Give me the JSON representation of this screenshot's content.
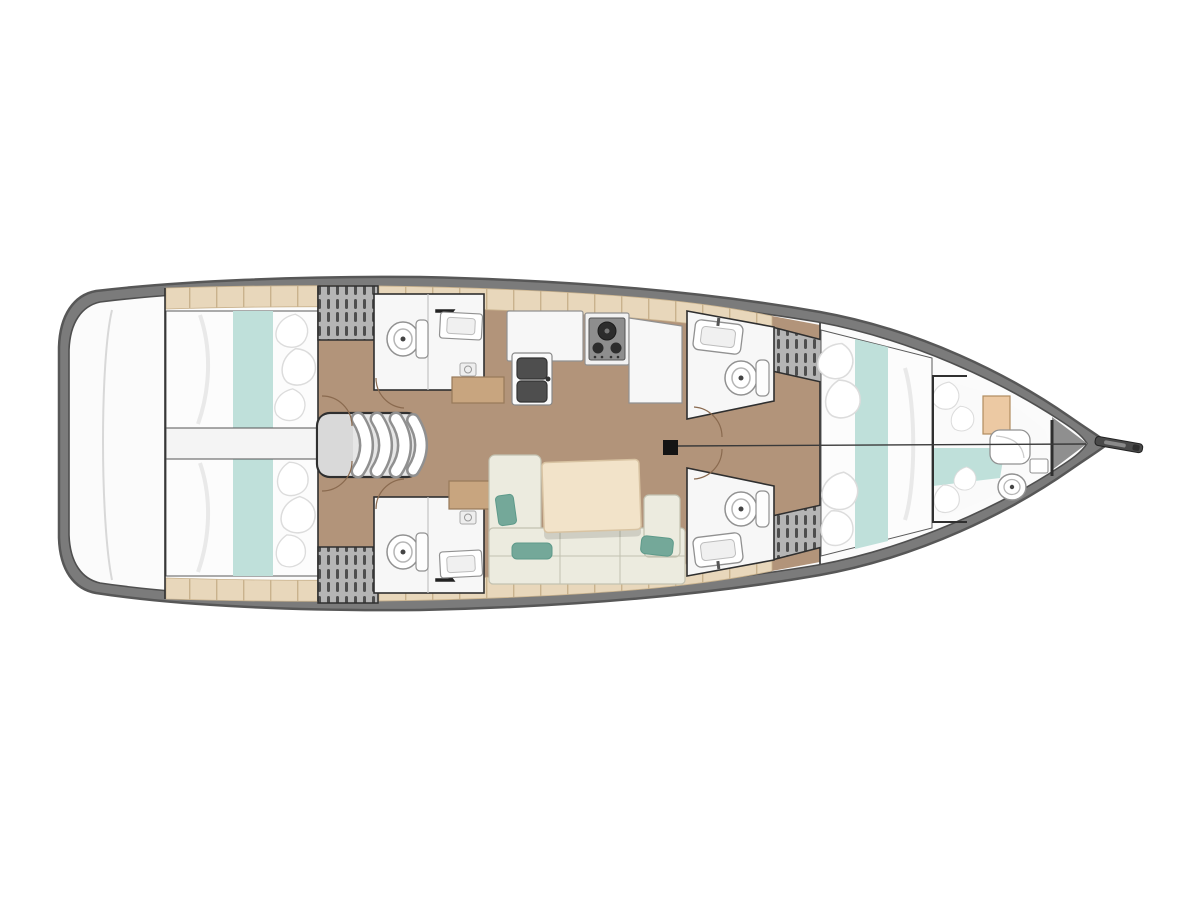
{
  "meta": {
    "view": "sailing-yacht-interior-floor-plan",
    "orientation": "bow-right"
  },
  "palette": {
    "bg": "#ffffff",
    "hullBand": "#7b7b7b",
    "hullEdge": "#575757",
    "deck": "#fbfbfb",
    "deckLine": "#4f4f4f",
    "bowWedge": "#8f8f8f",
    "floorTan": "#b2947a",
    "deckStrip": "#e8d7bb",
    "deckStripLine": "#c9b28d",
    "bedWhite": "#fcfcfc",
    "bedOutline": "#5a5a5a",
    "bedFold": "#e9e9e9",
    "pillow": "#ffffff",
    "pillowEdge": "#dcdcdc",
    "tealRunner": "#bfe0da",
    "tealCushion": "#74a899",
    "cushionEdge": "#5e9a8a",
    "sofaBase": "#ecebdf",
    "sofaLine": "#c2c1b0",
    "tableTop": "#f2e3c9",
    "tableEdge": "#d8c3a2",
    "tableShadow": "rgba(0,0,0,0.12)",
    "fixtureWhite": "#f7f7f7",
    "fixtureLine": "#919191",
    "roomLine": "#2f2f2f",
    "darkFixture": "#4e4e4e",
    "burner": "#2c2c2c",
    "wardrobeBg": "#b5b5b5",
    "wardrobeBar": "#4e4e4e",
    "stepTan": "#c8a57f",
    "stepEdge": "#97795a",
    "doorArc": "#8a6a4f",
    "mast": "#141414",
    "centerline": "#3a3a3a",
    "stairFrame": "#2f2f2f",
    "stairBg": "#e6e6e6",
    "stairLanding": "#d9d9d9",
    "cabinetWood": "#ecc9a3",
    "cabinetEdge": "#b08c5f",
    "bowsprit": "#4a4a4a"
  },
  "inventory": {
    "cabins": [
      "aft-cabin-port",
      "aft-cabin-starboard",
      "forward-cabin",
      "forepeak-berth"
    ],
    "heads": [
      "head-aft-port",
      "head-aft-starboard",
      "head-forward-port",
      "head-forward-starboard",
      "head-bow"
    ],
    "galley": [
      "counter-left",
      "double-sink",
      "stove",
      "counter-right"
    ],
    "salon": [
      "u-shaped-sofa",
      "salon-table",
      "cushions"
    ],
    "circulation": [
      "companionway-stairs",
      "aft-passage",
      "transom-platform"
    ],
    "storage": [
      "wardrobe-aft-port",
      "wardrobe-aft-starboard",
      "wardrobe-forward-port",
      "wardrobe-forward-starboard"
    ],
    "rig": [
      "mast",
      "bowsprit",
      "centerline"
    ]
  }
}
